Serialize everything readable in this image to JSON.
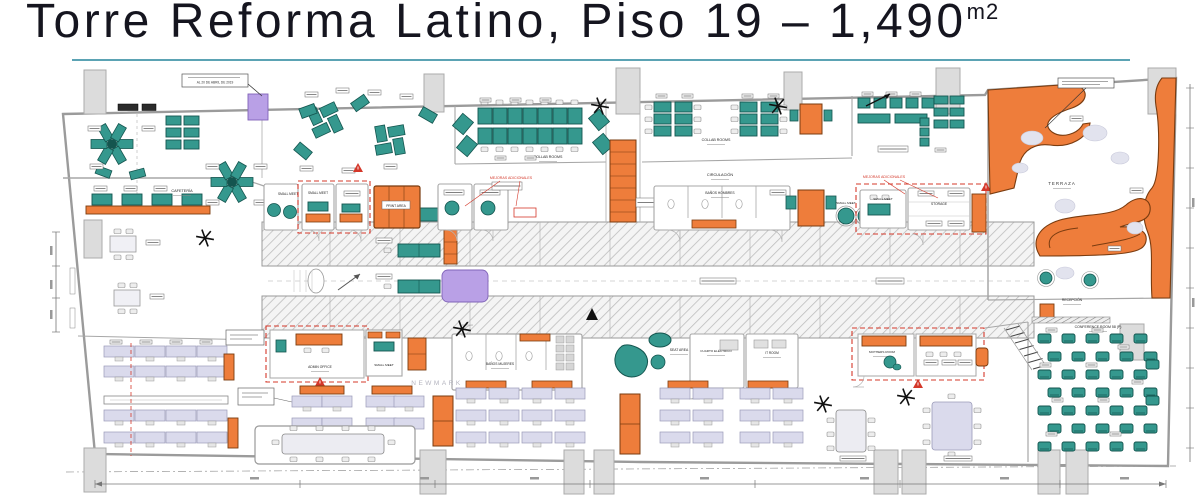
{
  "header": {
    "title": "Torre Reforma Latino, Piso 19 – 1,490",
    "superscript": "m2"
  },
  "plan_labels": [
    {
      "id": "cafeteria",
      "text": "CAFETERÍA"
    },
    {
      "id": "collab_a",
      "text": "COLLAB ROOMS"
    },
    {
      "id": "collab_b",
      "text": "COLLAB ROOMS"
    },
    {
      "id": "circulacion",
      "text": "CIRCULACIÓN"
    },
    {
      "id": "small_meet_1",
      "text": "SMALL MEET"
    },
    {
      "id": "small_meet_2",
      "text": "SMALL MEET"
    },
    {
      "id": "print_area",
      "text": "PRINT AREA"
    },
    {
      "id": "banos_hombres",
      "text": "BAÑOS HOMBRES"
    },
    {
      "id": "small_meet_3",
      "text": "SMALL MEET"
    },
    {
      "id": "small_meet_4",
      "text": "SMALL MEET"
    },
    {
      "id": "storage",
      "text": "STORAGE"
    },
    {
      "id": "admin_office",
      "text": "ADMIN OFFICE"
    },
    {
      "id": "small_meet_5",
      "text": "SMALL MEET"
    },
    {
      "id": "seat_area",
      "text": "SEAT AREA"
    },
    {
      "id": "banos_mujeres",
      "text": "BAÑOS MUJERES"
    },
    {
      "id": "cuarto_electrico",
      "text": "CUARTO ELÉCTRICO"
    },
    {
      "id": "it_room",
      "text": "IT ROOM"
    },
    {
      "id": "terraza",
      "text": "TERRAZA"
    },
    {
      "id": "recepcion",
      "text": "RECEPCIÓN"
    },
    {
      "id": "mothers_room",
      "text": "MOTHERS ROOM"
    },
    {
      "id": "conference_room",
      "text": "CONFERENCE ROOM 58 (P)"
    },
    {
      "id": "newmark",
      "text": "NEWMARK"
    },
    {
      "id": "red_note_1",
      "text": "MEJORAS ADICIONALES"
    },
    {
      "id": "red_note_2",
      "text": "MEJORAS ADICIONALES"
    },
    {
      "id": "date_note",
      "text": "AL 20 DE ABRIL DE 2019"
    }
  ],
  "colors": {
    "teal": "#35988e",
    "teal_dark": "#14554f",
    "orange": "#ee7d3b",
    "orange_dark": "#7a3c10",
    "lavender": "#dadaec",
    "lavender_dark": "#9a9ab8",
    "purple": "#b9a0e6",
    "purple_dark": "#8063b8",
    "red": "#d4382a",
    "underline": "#5ba3b4",
    "wall": "#9b9b9b",
    "hatch_line": "#bdbdbd",
    "title": "#15151f",
    "watermark": "#a7a7b4",
    "cloud": "#e2e3ee"
  }
}
